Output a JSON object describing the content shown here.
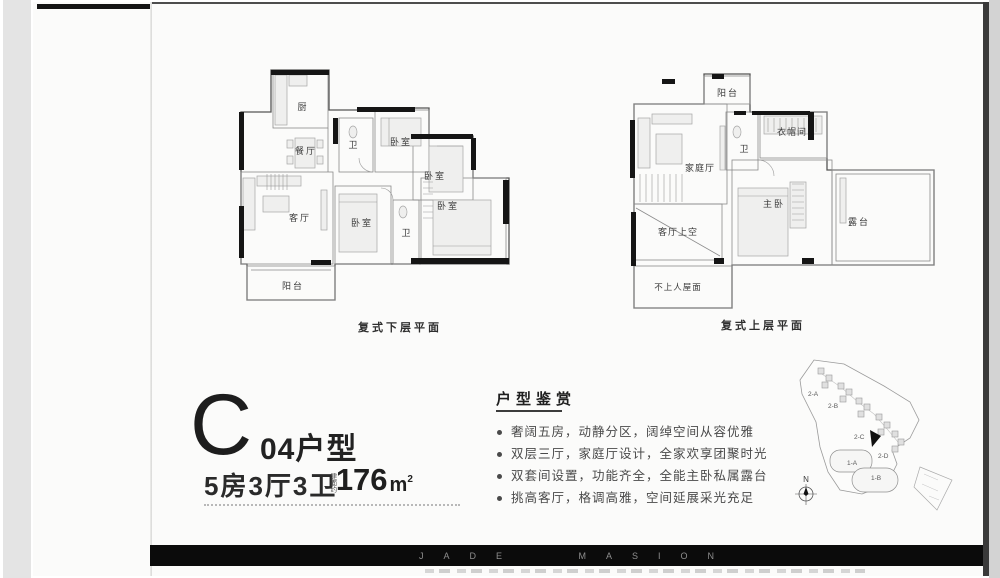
{
  "page": {
    "watermark": "JADE MASION"
  },
  "unit": {
    "letter": "C",
    "name": "04户型",
    "layout": "5房3厅3卫",
    "area_label": "建面约",
    "area_value": "176",
    "area_unit": "m",
    "area_sup": "2"
  },
  "features": {
    "title": "户型鉴赏",
    "bullets": [
      "奢阔五房，动静分区，阔绰空间从容优雅",
      "双层三厅，家庭厅设计，全家欢享团聚时光",
      "双套间设置，功能齐全，全能主卧私属露台",
      "挑高客厅，格调高雅，空间延展采光充足"
    ]
  },
  "plans": {
    "lower": {
      "caption": "复式下层平面",
      "rooms": {
        "kitchen": "厨",
        "dining": "餐厅",
        "bath1": "卫",
        "bed1": "卧室",
        "bed2": "卧室",
        "living": "客厅",
        "bed3": "卧室",
        "bath2": "卫",
        "bed4": "卧室",
        "balcony": "阳台"
      }
    },
    "upper": {
      "caption": "复式上层平面",
      "rooms": {
        "balcony": "阳台",
        "closet": "衣帽间",
        "bath": "卫",
        "family": "家庭厅",
        "master": "主卧",
        "terrace": "露台",
        "void": "客厅上空",
        "roof": "不上人屋面"
      }
    }
  },
  "siteplan": {
    "compass": "N",
    "blocks": {
      "b2a": "2-A",
      "b2b": "2-B",
      "b2c": "2-C",
      "b2d": "2-D",
      "b1a": "1-A",
      "b1b": "1-B"
    }
  }
}
